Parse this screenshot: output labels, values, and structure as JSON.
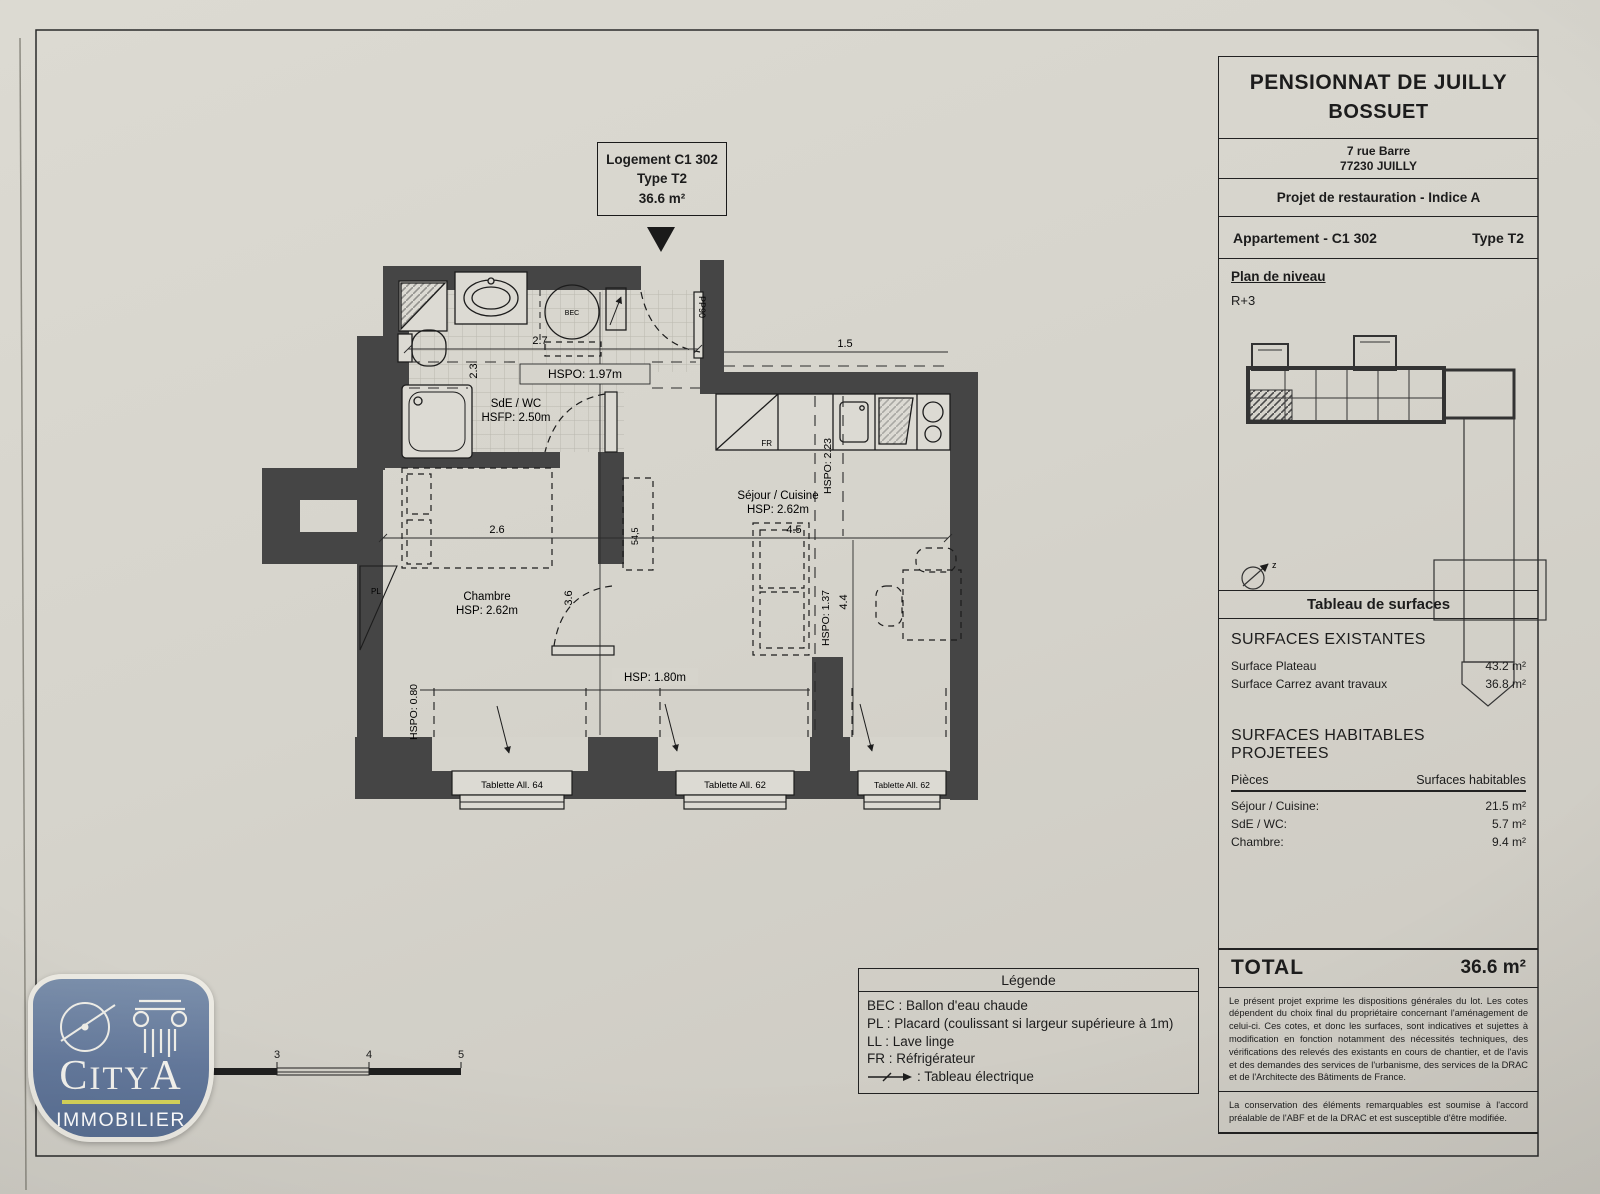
{
  "colors": {
    "paper": "#d6d4cc",
    "wall": "#454545",
    "logo_blue": "#64799c",
    "logo_yellow": "#d6d45a"
  },
  "logement_box": {
    "line1": "Logement C1 302",
    "line2": "Type T2",
    "line3": "36.6 m²"
  },
  "title_block": {
    "title1": "PENSIONNAT DE JUILLY",
    "title2": "BOSSUET",
    "address1": "7 rue Barre",
    "address2": "77230 JUILLY",
    "project": "Projet de restauration - Indice A",
    "apartment": "Appartement - C1 302",
    "type": "Type T2",
    "level_label": "Plan de niveau",
    "level_value": "R+3",
    "surfaces_header": "Tableau de surfaces",
    "existing_header": "SURFACES EXISTANTES",
    "existing_rows": [
      {
        "label": "Surface Plateau",
        "value": "43.2 m²"
      },
      {
        "label": "Surface Carrez avant travaux",
        "value": "36.8 m²"
      }
    ],
    "projected_header": "SURFACES HABITABLES PROJETEES",
    "col_pieces": "Pièces",
    "col_surfaces": "Surfaces habitables",
    "projected_rows": [
      {
        "label": "Séjour / Cuisine:",
        "value": "21.5 m²"
      },
      {
        "label": "SdE / WC:",
        "value": "5.7 m²"
      },
      {
        "label": "Chambre:",
        "value": "9.4 m²"
      }
    ],
    "total_label": "TOTAL",
    "total_value": "36.6 m²",
    "note1": "Le présent projet exprime les dispositions générales du lot. Les cotes dépendent du choix final du propriétaire concernant l'aménagement de celui-ci. Ces cotes, et donc les surfaces, sont indicatives et sujettes à modification en fonction notamment des nécessités techniques, des vérifications des relevés des existants en cours de chantier, et de l'avis et des demandes des services de l'urbanisme, des services de la DRAC et de l'Architecte des Bâtiments de France.",
    "note2": "La conservation des éléments remarquables est soumise à l'accord préalable de l'ABF et de la DRAC et est susceptible d'être modifiée."
  },
  "legend": {
    "title": "Légende",
    "items": [
      "BEC : Ballon d'eau chaude",
      "PL : Placard (coulissant si largeur supérieure à 1m)",
      "LL : Lave linge",
      "FR : Réfrigérateur"
    ],
    "electric_label": ": Tableau électrique"
  },
  "logo": {
    "name_c": "C",
    "name_mid": "ITY",
    "name_a": "A",
    "sub": "IMMOBILIER"
  },
  "scale_bar": {
    "labels": [
      "2",
      "3",
      "4",
      "5"
    ]
  },
  "plan": {
    "rooms": {
      "sde": {
        "name": "SdE / WC",
        "h": "HSFP: 2.50m"
      },
      "sejour": {
        "name": "Séjour / Cuisine",
        "h": "HSP: 2.62m"
      },
      "chambre": {
        "name": "Chambre",
        "h": "HSP: 2.62m"
      }
    },
    "dims": {
      "w_bath": "2.7",
      "h_bath": "2.3",
      "w_entry": "1.5",
      "w_chambre": "2.6",
      "w_sejour": "4.5",
      "h_sejour": "4.4",
      "h_chambre": "3.6",
      "placard": "54,5"
    },
    "heights": {
      "hspo197": "HSPO: 1.97m",
      "hspo223": "HSPO: 2.23",
      "hspo137": "HSPO: 1.37",
      "hspo080": "HSPO: 0.80",
      "hsp180": "HSP: 1.80m"
    },
    "labels": {
      "door": "PP90",
      "bec": "BEC",
      "fridge": "FR",
      "placard": "PL",
      "north": "z"
    },
    "windows": [
      "Tablette All. 64",
      "Tablette All. 62",
      "Tablette All. 62"
    ]
  }
}
